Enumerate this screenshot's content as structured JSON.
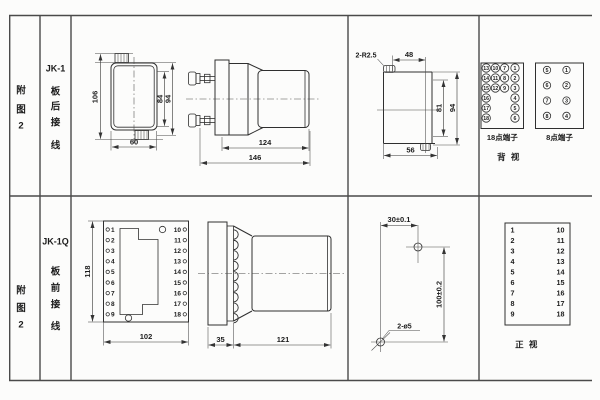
{
  "left_panel": {
    "row1": {
      "fig": [
        "附",
        "图",
        "2"
      ],
      "model": "JK-1",
      "wiring": [
        "板",
        "后",
        "接",
        "线"
      ]
    },
    "row2": {
      "fig": [
        "附",
        "图",
        "2"
      ],
      "model": "JK-1Q",
      "wiring": [
        "板",
        "前",
        "接",
        "线"
      ]
    }
  },
  "row1": {
    "front": {
      "dim_height": "106",
      "dim_width": "60",
      "dim_inner": "84",
      "dim_outer": "94"
    },
    "side": {
      "dim_body": "124",
      "dim_total": "146"
    },
    "cutout": {
      "note_radius": "2-R2.5",
      "dim_top": "48",
      "dim_inner": "81",
      "dim_outer": "94",
      "dim_bottom": "56"
    },
    "term18": {
      "label": "18点端子",
      "columns": [
        [
          13,
          14,
          15,
          16,
          17,
          18
        ],
        [
          10,
          11,
          12
        ],
        [
          7,
          8,
          9
        ],
        [
          1,
          2,
          3,
          4,
          5,
          6
        ]
      ]
    },
    "term8": {
      "label": "8点端子",
      "left": [
        5,
        6,
        7,
        8
      ],
      "right": [
        1,
        2,
        3,
        4
      ]
    },
    "view_label": "背 视"
  },
  "row2": {
    "front": {
      "dim_height": "118",
      "dim_width": "102",
      "left": [
        1,
        2,
        3,
        4,
        5,
        6,
        7,
        8,
        9
      ],
      "right": [
        10,
        11,
        12,
        13,
        14,
        15,
        16,
        17,
        18
      ]
    },
    "side": {
      "dim_flange": "35",
      "dim_body": "121"
    },
    "drill": {
      "dim_h": "30±0.1",
      "dim_v": "100±0.2",
      "note_holes": "2-ø5"
    },
    "table": {
      "left": [
        1,
        2,
        3,
        4,
        5,
        6,
        7,
        8,
        9
      ],
      "right": [
        10,
        11,
        12,
        13,
        14,
        15,
        16,
        17,
        18
      ],
      "view_label": "正 视"
    }
  }
}
